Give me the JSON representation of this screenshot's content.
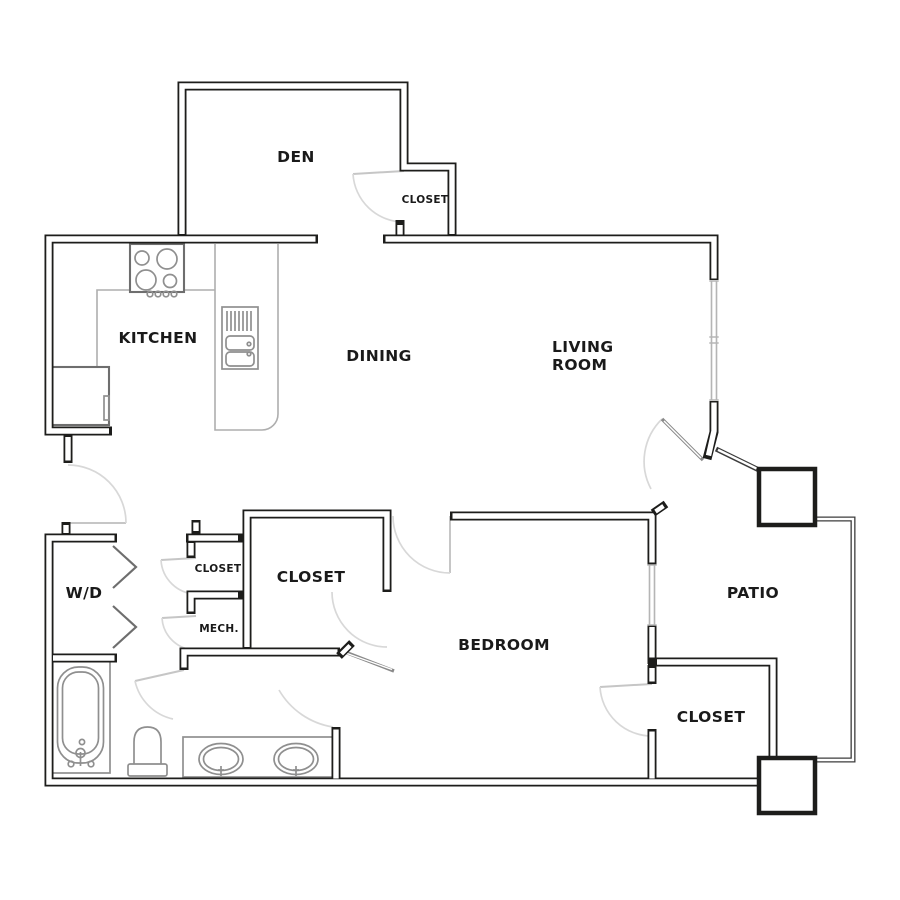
{
  "rooms": {
    "den": {
      "label": "DEN"
    },
    "den_closet": {
      "label": "CLOSET"
    },
    "kitchen": {
      "label": "KITCHEN"
    },
    "dining": {
      "label": "DINING"
    },
    "living_room": {
      "line1": "LIVING",
      "line2": "ROOM"
    },
    "washer_dryer": {
      "label": "W/D"
    },
    "hall_closet": {
      "label": "CLOSET"
    },
    "mechanical": {
      "label": "MECH."
    },
    "bedroom_closet": {
      "label": "CLOSET"
    },
    "bedroom": {
      "label": "BEDROOM"
    },
    "patio": {
      "label": "PATIO"
    },
    "master_closet": {
      "label": "CLOSET"
    }
  },
  "colors": {
    "wall": "#1d1d1b",
    "label": "#1a1a1a",
    "fixture": "#8f8f8f",
    "counter": "#aeaeae",
    "appliance": "#6e6e6e",
    "door_arc": "#d8d8d8",
    "door_leaf": "#c6c6c6",
    "window": "#b5b5b5",
    "railing": "#3c3c3c",
    "background": "#ffffff"
  }
}
